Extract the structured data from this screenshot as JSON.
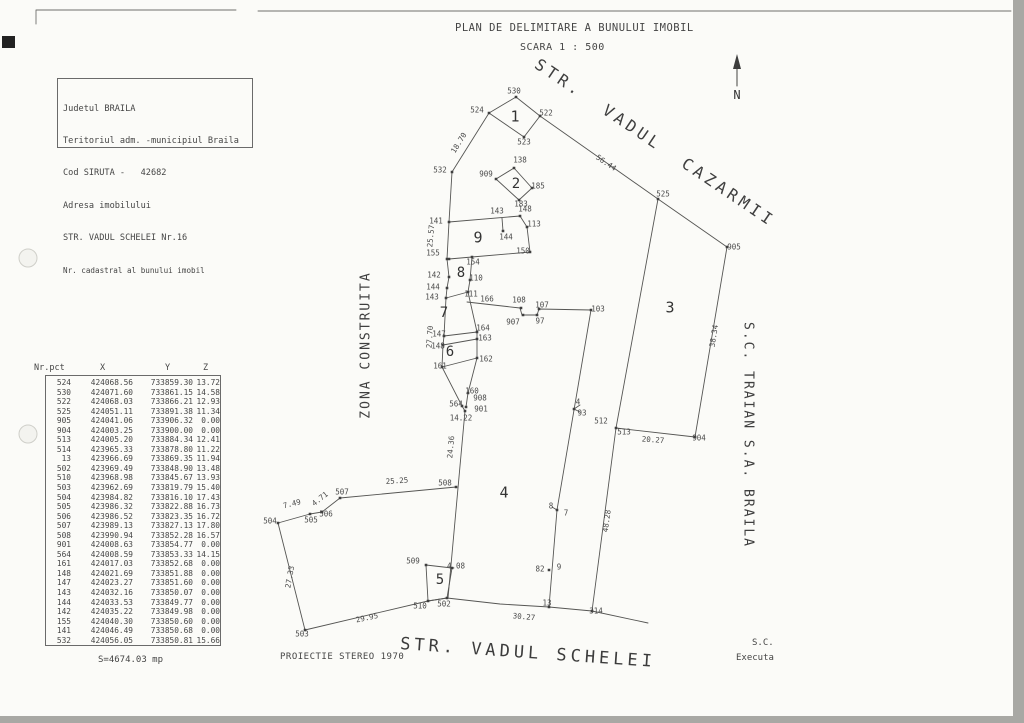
{
  "title": {
    "line1": "PLAN DE DELIMITARE A BUNULUI IMOBIL",
    "line2": "SCARA 1 : 500"
  },
  "info_box": {
    "lines": [
      "Judetul BRAILA",
      "Teritoriul adm. -municipiul Braila",
      "Cod SIRUTA -   42682",
      "Adresa imobilului",
      "STR. VADUL SCHELEI Nr.16",
      "Nr. cadastral al bunului imobil"
    ]
  },
  "compass": {
    "label": "N"
  },
  "table": {
    "headers": [
      "Nr.pct",
      "X",
      "Y",
      "Z"
    ],
    "rows": [
      [
        "524",
        "424068.56",
        "733859.30",
        "13.72"
      ],
      [
        "530",
        "424071.60",
        "733861.15",
        "14.58"
      ],
      [
        "522",
        "424068.03",
        "733866.21",
        "12.93"
      ],
      [
        "525",
        "424051.11",
        "733891.38",
        "11.34"
      ],
      [
        "905",
        "424041.06",
        "733906.32",
        "0.00"
      ],
      [
        "904",
        "424003.25",
        "733900.00",
        "0.00"
      ],
      [
        "513",
        "424005.20",
        "733884.34",
        "12.41"
      ],
      [
        "514",
        "423965.33",
        "733878.80",
        "11.22"
      ],
      [
        "13",
        "423966.69",
        "733869.35",
        "11.94"
      ],
      [
        "502",
        "423969.49",
        "733848.90",
        "13.48"
      ],
      [
        "510",
        "423968.98",
        "733845.67",
        "13.93"
      ],
      [
        "503",
        "423962.69",
        "733819.79",
        "15.40"
      ],
      [
        "504",
        "423984.82",
        "733816.10",
        "17.43"
      ],
      [
        "505",
        "423986.32",
        "733822.88",
        "16.73"
      ],
      [
        "506",
        "423986.52",
        "733823.35",
        "16.72"
      ],
      [
        "507",
        "423989.13",
        "733827.13",
        "17.80"
      ],
      [
        "508",
        "423990.94",
        "733852.28",
        "16.57"
      ],
      [
        "901",
        "424008.63",
        "733854.77",
        "0.00"
      ],
      [
        "564",
        "424008.59",
        "733853.33",
        "14.15"
      ],
      [
        "161",
        "424017.03",
        "733852.68",
        "0.00"
      ],
      [
        "148",
        "424021.69",
        "733851.88",
        "0.00"
      ],
      [
        "147",
        "424023.27",
        "733851.60",
        "0.00"
      ],
      [
        "143",
        "424032.16",
        "733850.07",
        "0.00"
      ],
      [
        "144",
        "424033.53",
        "733849.77",
        "0.00"
      ],
      [
        "142",
        "424035.22",
        "733849.98",
        "0.00"
      ],
      [
        "155",
        "424040.30",
        "733850.60",
        "0.00"
      ],
      [
        "141",
        "424046.49",
        "733850.68",
        "0.00"
      ],
      [
        "532",
        "424056.05",
        "733850.81",
        "15.66"
      ]
    ],
    "area_label": "S=4674.03 mp"
  },
  "footer": {
    "projection": "PROIECTIE STEREO 1970",
    "street_bottom": "STR. VADUL SCHELEI",
    "sc": "S.C.",
    "executa": "Executa"
  },
  "plan": {
    "labels": [
      {
        "t": "530",
        "x": 514,
        "y": 91
      },
      {
        "t": "524",
        "x": 477,
        "y": 110
      },
      {
        "t": "522",
        "x": 546,
        "y": 113
      },
      {
        "t": "523",
        "x": 524,
        "y": 142
      },
      {
        "t": "1",
        "x": 515,
        "y": 117,
        "fs": 15
      },
      {
        "t": "18.70",
        "x": 459,
        "y": 143,
        "r": -58
      },
      {
        "t": "532",
        "x": 440,
        "y": 170
      },
      {
        "t": "138",
        "x": 520,
        "y": 160
      },
      {
        "t": "909",
        "x": 486,
        "y": 174
      },
      {
        "t": "2",
        "x": 516,
        "y": 184,
        "fs": 14
      },
      {
        "t": "185",
        "x": 538,
        "y": 186
      },
      {
        "t": "183",
        "x": 521,
        "y": 204
      },
      {
        "t": "STR.  VADUL  CAZARMII",
        "x": 655,
        "y": 143,
        "r": 34,
        "fs": 16,
        "ls": 4,
        "street": true
      },
      {
        "t": "56.44",
        "x": 606,
        "y": 163,
        "r": 34
      },
      {
        "t": "525",
        "x": 663,
        "y": 194
      },
      {
        "t": "905",
        "x": 734,
        "y": 247
      },
      {
        "t": "3",
        "x": 670,
        "y": 308,
        "fs": 15
      },
      {
        "t": "38.34",
        "x": 714,
        "y": 336,
        "r": -81
      },
      {
        "t": "141",
        "x": 436,
        "y": 221
      },
      {
        "t": "25.57",
        "x": 431,
        "y": 236,
        "r": -85
      },
      {
        "t": "143",
        "x": 497,
        "y": 211
      },
      {
        "t": "148",
        "x": 525,
        "y": 209
      },
      {
        "t": "113",
        "x": 534,
        "y": 224
      },
      {
        "t": "144",
        "x": 506,
        "y": 237
      },
      {
        "t": "9",
        "x": 478,
        "y": 238,
        "fs": 15
      },
      {
        "t": "155",
        "x": 433,
        "y": 253
      },
      {
        "t": "154",
        "x": 473,
        "y": 262
      },
      {
        "t": "150",
        "x": 523,
        "y": 251
      },
      {
        "t": "8",
        "x": 461,
        "y": 273,
        "fs": 14
      },
      {
        "t": "142",
        "x": 434,
        "y": 275
      },
      {
        "t": "144",
        "x": 433,
        "y": 287
      },
      {
        "t": "143",
        "x": 432,
        "y": 297
      },
      {
        "t": "110",
        "x": 476,
        "y": 278
      },
      {
        "t": "111",
        "x": 471,
        "y": 294
      },
      {
        "t": "7",
        "x": 444,
        "y": 313,
        "fs": 14
      },
      {
        "t": "166",
        "x": 487,
        "y": 299
      },
      {
        "t": "108",
        "x": 519,
        "y": 300
      },
      {
        "t": "107",
        "x": 542,
        "y": 305
      },
      {
        "t": "907",
        "x": 513,
        "y": 322
      },
      {
        "t": "97",
        "x": 540,
        "y": 321
      },
      {
        "t": "103",
        "x": 598,
        "y": 309
      },
      {
        "t": "27.70",
        "x": 430,
        "y": 337,
        "r": -86
      },
      {
        "t": "147",
        "x": 439,
        "y": 334
      },
      {
        "t": "148",
        "x": 438,
        "y": 346
      },
      {
        "t": "164",
        "x": 483,
        "y": 328
      },
      {
        "t": "163",
        "x": 485,
        "y": 338
      },
      {
        "t": "6",
        "x": 450,
        "y": 352,
        "fs": 14
      },
      {
        "t": "162",
        "x": 486,
        "y": 359
      },
      {
        "t": "161",
        "x": 440,
        "y": 366
      },
      {
        "t": "160",
        "x": 472,
        "y": 391
      },
      {
        "t": "908",
        "x": 480,
        "y": 398
      },
      {
        "t": "564",
        "x": 456,
        "y": 404
      },
      {
        "t": "901",
        "x": 481,
        "y": 409
      },
      {
        "t": "14.22",
        "x": 461,
        "y": 418
      },
      {
        "t": "24.36",
        "x": 451,
        "y": 447,
        "r": -85
      },
      {
        "t": "ZONA CONSTRUITA",
        "x": 366,
        "y": 345,
        "r": -90,
        "fs": 13,
        "ls": 2,
        "street": true
      },
      {
        "t": "4",
        "x": 504,
        "y": 493,
        "fs": 15
      },
      {
        "t": "7.49",
        "x": 292,
        "y": 504,
        "r": -14
      },
      {
        "t": "504",
        "x": 270,
        "y": 521
      },
      {
        "t": "505",
        "x": 311,
        "y": 520
      },
      {
        "t": "506",
        "x": 326,
        "y": 514
      },
      {
        "t": "4.71",
        "x": 320,
        "y": 499,
        "r": -38
      },
      {
        "t": "507",
        "x": 342,
        "y": 492
      },
      {
        "t": "25.25",
        "x": 397,
        "y": 481,
        "r": -4
      },
      {
        "t": "508",
        "x": 445,
        "y": 483
      },
      {
        "t": "8",
        "x": 551,
        "y": 506
      },
      {
        "t": "7",
        "x": 566,
        "y": 513
      },
      {
        "t": "4",
        "x": 578,
        "y": 402
      },
      {
        "t": "93",
        "x": 582,
        "y": 413
      },
      {
        "t": "512",
        "x": 601,
        "y": 421
      },
      {
        "t": "513",
        "x": 624,
        "y": 432
      },
      {
        "t": "20.27",
        "x": 653,
        "y": 440,
        "r": 4
      },
      {
        "t": "904",
        "x": 699,
        "y": 438
      },
      {
        "t": "48.28",
        "x": 607,
        "y": 521,
        "r": -82
      },
      {
        "t": "82",
        "x": 540,
        "y": 569
      },
      {
        "t": "9",
        "x": 559,
        "y": 567
      },
      {
        "t": "S.C. TRAIAN S.A. BRAILA",
        "x": 748,
        "y": 435,
        "r": 90,
        "fs": 13,
        "ls": 2,
        "street": true
      },
      {
        "t": "509",
        "x": 413,
        "y": 561
      },
      {
        "t": "4.08",
        "x": 456,
        "y": 566
      },
      {
        "t": "5",
        "x": 440,
        "y": 580,
        "fs": 14
      },
      {
        "t": "510",
        "x": 420,
        "y": 606
      },
      {
        "t": "502",
        "x": 444,
        "y": 604
      },
      {
        "t": "13",
        "x": 547,
        "y": 603
      },
      {
        "t": "314",
        "x": 596,
        "y": 611
      },
      {
        "t": "30.27",
        "x": 524,
        "y": 617,
        "r": 5
      },
      {
        "t": "29.95",
        "x": 367,
        "y": 618,
        "r": -12
      },
      {
        "t": "27.33",
        "x": 290,
        "y": 577,
        "r": -80
      },
      {
        "t": "503",
        "x": 302,
        "y": 634
      }
    ]
  }
}
